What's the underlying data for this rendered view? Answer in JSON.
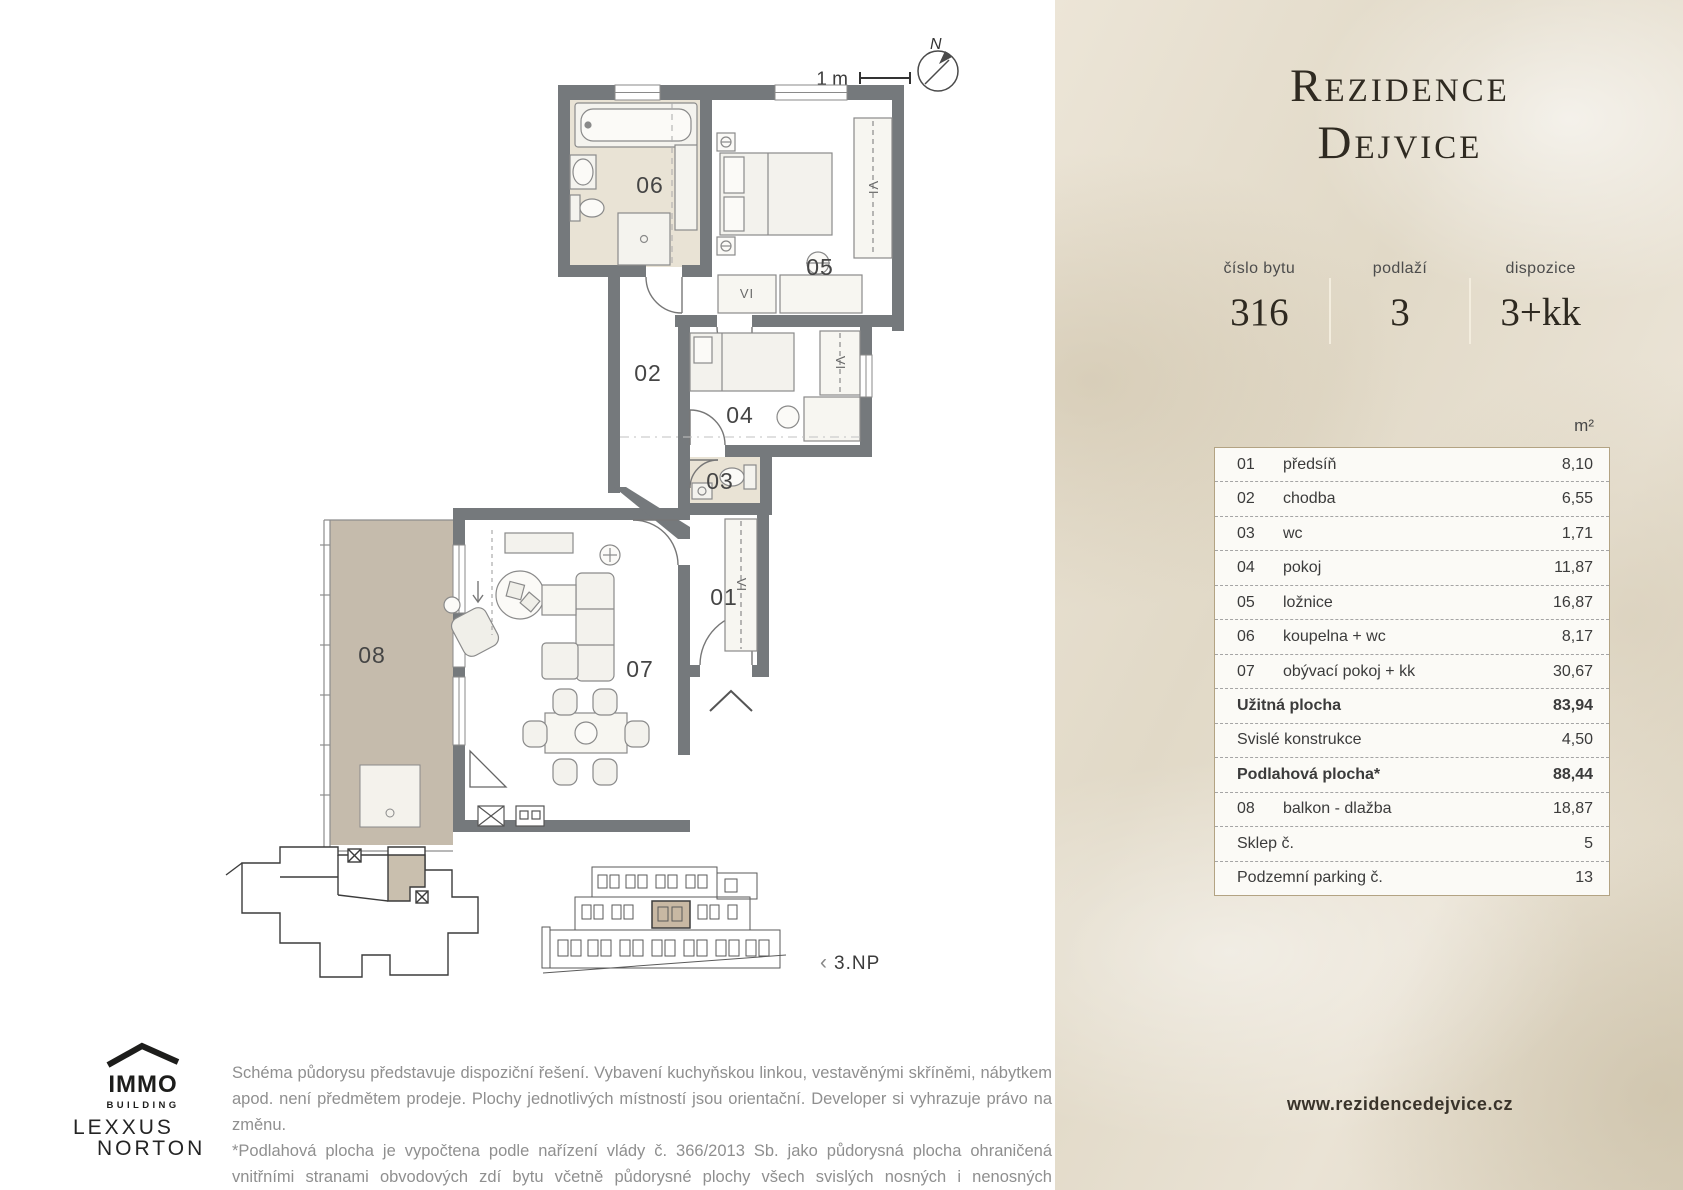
{
  "header": {
    "title_line1": "Rezidence",
    "title_line2": "Dejvice"
  },
  "info": [
    {
      "label": "číslo bytu",
      "value": "316"
    },
    {
      "label": "podlaží",
      "value": "3"
    },
    {
      "label": "dispozice",
      "value": "3+kk"
    }
  ],
  "area_table": {
    "unit_header": "m²",
    "rows": [
      {
        "num": "01",
        "name": "předsíň",
        "value": "8,10"
      },
      {
        "num": "02",
        "name": "chodba",
        "value": "6,55"
      },
      {
        "num": "03",
        "name": "wc",
        "value": "1,71"
      },
      {
        "num": "04",
        "name": "pokoj",
        "value": "11,87"
      },
      {
        "num": "05",
        "name": "ložnice",
        "value": "16,87"
      },
      {
        "num": "06",
        "name": "koupelna + wc",
        "value": "8,17"
      },
      {
        "num": "07",
        "name": "obývací pokoj + kk",
        "value": "30,67"
      },
      {
        "num": "",
        "name": "Užitná plocha",
        "value": "83,94",
        "bold": true
      },
      {
        "num": "",
        "name": "Svislé konstrukce",
        "value": "4,50"
      },
      {
        "num": "",
        "name": "Podlahová plocha*",
        "value": "88,44",
        "bold": true
      },
      {
        "num": "08",
        "name": "balkon - dlažba",
        "value": "18,87"
      },
      {
        "num": "",
        "name": "Sklep č.",
        "value": "5"
      },
      {
        "num": "",
        "name": "Podzemní parking č.",
        "value": "13"
      }
    ]
  },
  "plan": {
    "scale_label": "1 m",
    "compass_label": "N",
    "floor_nav_arrow": "‹",
    "floor_label": "3.NP",
    "wardrobe_label": "VI",
    "rooms": {
      "r01": "01",
      "r02": "02",
      "r03": "03",
      "r04": "04",
      "r05": "05",
      "r06": "06",
      "r07": "07",
      "r08": "08"
    }
  },
  "logos": {
    "immo": {
      "name": "IMMO",
      "tagline": "BUILDING"
    },
    "lexxus": {
      "line1": "LEXXUS",
      "line2": "NORTON"
    }
  },
  "disclaimer": {
    "p1": "Schéma půdorysu představuje dispoziční řešení. Vybavení kuchyňskou linkou, vestavěnými skříněmi, nábytkem apod. není předmětem prodeje. Plochy jednotlivých místností jsou orientační. Developer si vyhrazuje právo na změnu.",
    "p2": "*Podlahová plocha je vypočtena podle nařízení vlády č. 366/2013 Sb. jako půdorysná plocha ohraničená vnitřními stranami obvodových zdí bytu včetně půdorysné plochy všech svislých nosných i nenosných konstrukcí uvnitř bytu. Nezahrnuje balkony, lodžie, terasy, předzahrádky a jiné zpevněné plochy."
  },
  "footer": {
    "website": "www.rezidencedejvice.cz"
  }
}
